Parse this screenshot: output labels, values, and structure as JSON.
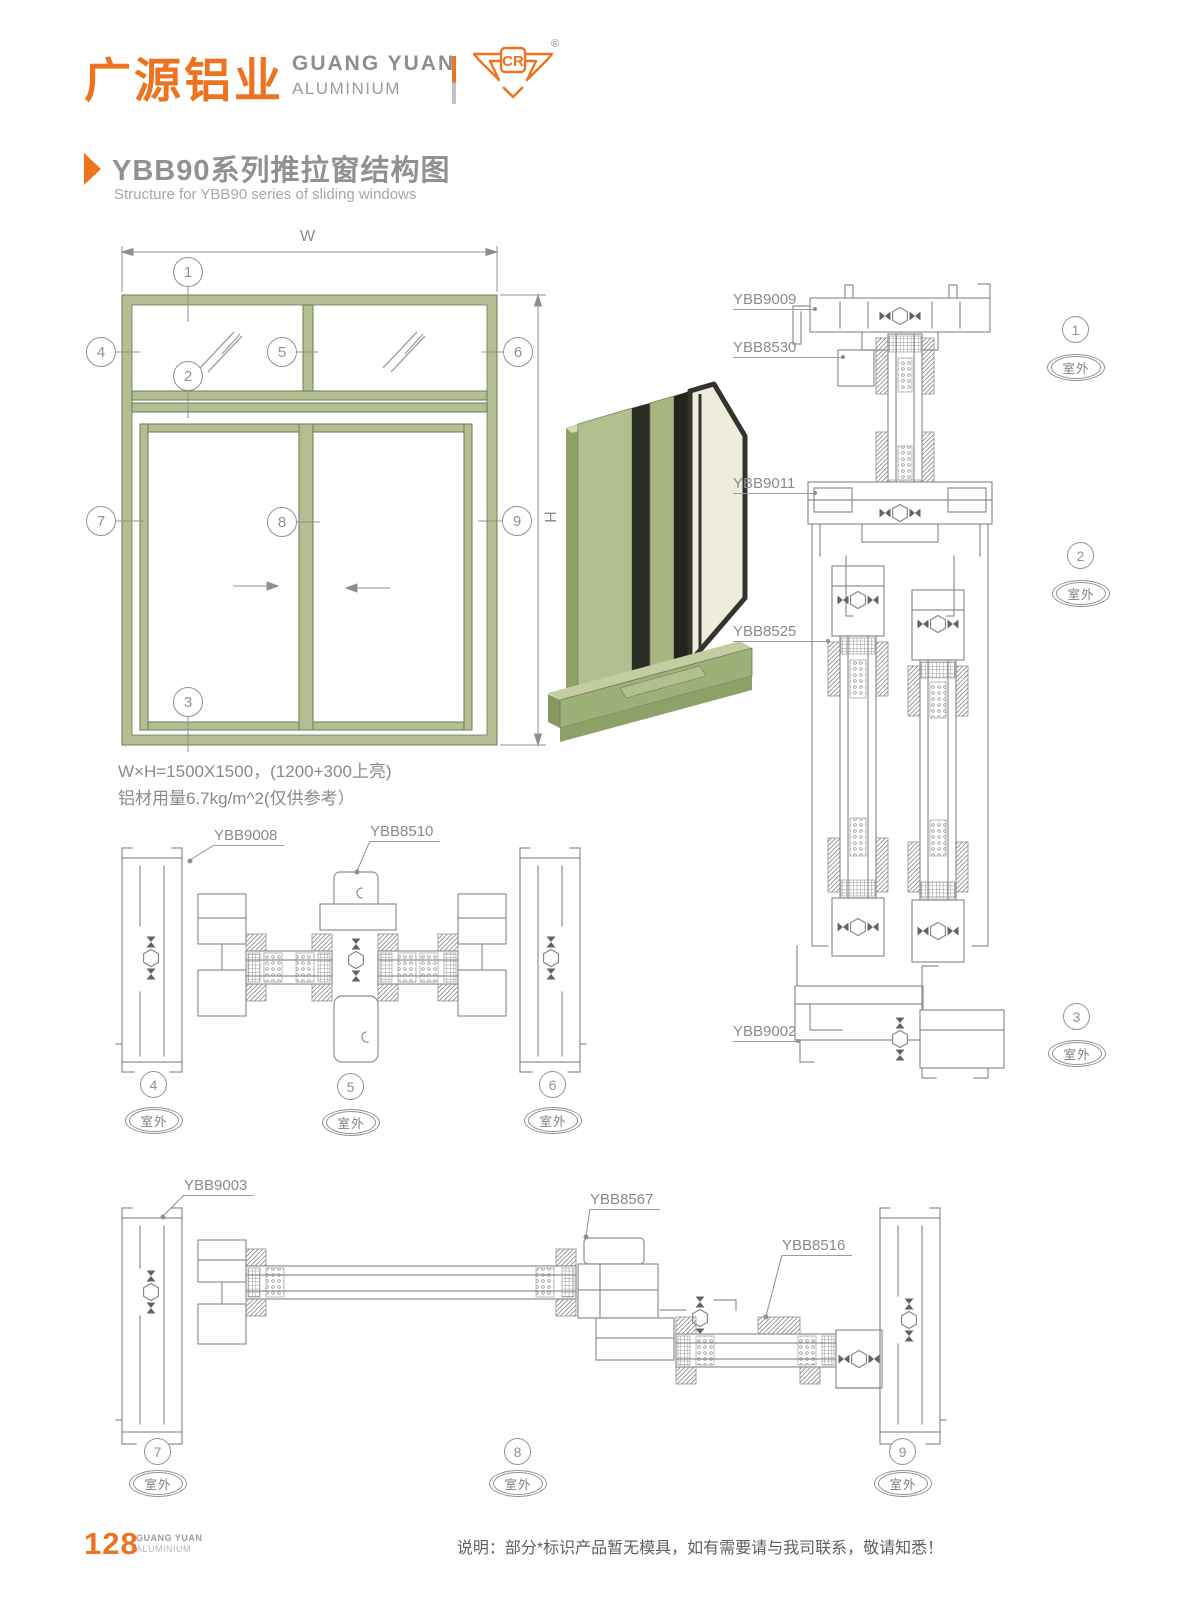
{
  "brand": {
    "logo_cn": "广源铝业",
    "logo_en1": "GUANG YUAN",
    "logo_en2": "ALUMINIUM",
    "logo_mark": "CR",
    "registered": "®"
  },
  "title": {
    "cn": "YBB90系列推拉窗结构图",
    "en": "Structure for YBB90 series of sliding windows"
  },
  "elevation": {
    "dim_w": "W",
    "dim_h": "H",
    "spec1": "W×H=1500X1500，(1200+300上亮)",
    "spec2": "铝材用量6.7kg/m^2(仅供参考）",
    "markers": [
      "1",
      "2",
      "3",
      "4",
      "5",
      "6",
      "7",
      "8",
      "9"
    ]
  },
  "sections": {
    "outdoor": "室外",
    "labels": {
      "l9009": "YBB9009",
      "l8530": "YBB8530",
      "l9011": "YBB9011",
      "l8525": "YBB8525",
      "l9002": "YBB9002",
      "l9008": "YBB9008",
      "l8510": "YBB8510",
      "l9003": "YBB9003",
      "l8567": "YBB8567",
      "l8516": "YBB8516"
    },
    "markers": [
      "1",
      "2",
      "3",
      "4",
      "5",
      "6",
      "7",
      "8",
      "9"
    ]
  },
  "footer": {
    "page": "128",
    "brand1": "GUANG YUAN",
    "brand2": "ALUMINIUM",
    "note": "说明：部分*标识产品暂无模具，如有需要请与我司联系，敬请知悉！"
  },
  "colors": {
    "accent": "#ee7320",
    "frame_green": "#b4be93",
    "line_gray": "#8d9094"
  }
}
